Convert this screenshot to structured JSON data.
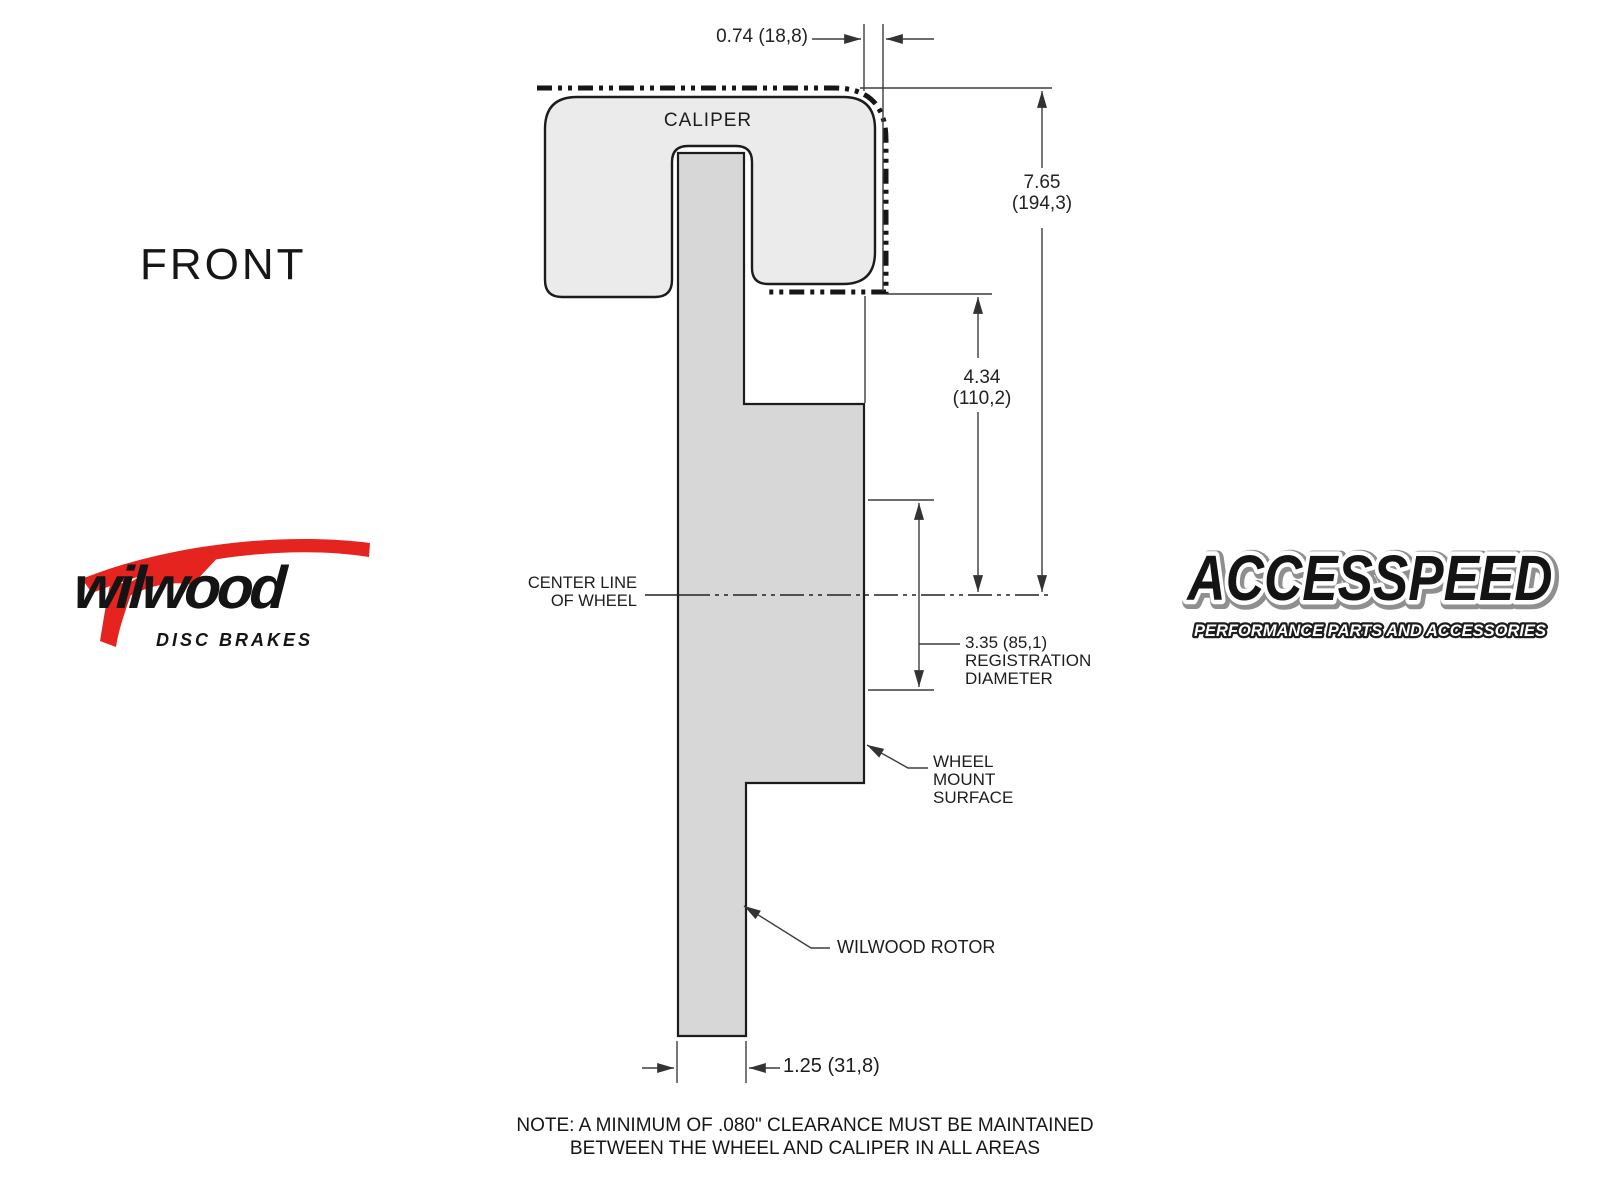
{
  "colors": {
    "background": "#ffffff",
    "caliper_fill": "#ebebeb",
    "rotor_fill": "#d7d7d7",
    "outline": "#1c1c1c",
    "dimension_line": "#3d3d3d",
    "wilwood_red": "#e5231f",
    "logo_black": "#141414"
  },
  "front_label": "FRONT",
  "caliper_label": "CALIPER",
  "dimensions": {
    "overhang": "0.74 (18,8)",
    "height_in": "7.65",
    "height_mm": "(194,3)",
    "mount_to_center_in": "4.34",
    "mount_to_center_mm": "(110,2)",
    "registration": "3.35 (85,1)",
    "registration_label1": "REGISTRATION",
    "registration_label2": "DIAMETER",
    "rotor_width": "1.25 (31,8)"
  },
  "labels": {
    "centerline1": "CENTER LINE",
    "centerline2": "OF WHEEL",
    "wheel_mount1": "WHEEL",
    "wheel_mount2": "MOUNT",
    "wheel_mount3": "SURFACE",
    "rotor": "WILWOOD ROTOR"
  },
  "note": {
    "line1": "NOTE: A MINIMUM OF .080\" CLEARANCE MUST BE MAINTAINED",
    "line2": "BETWEEN THE WHEEL AND CALIPER IN ALL AREAS"
  },
  "logos": {
    "wilwood": {
      "name": "wilwood",
      "tagline": "DISC BRAKES"
    },
    "accesspeed": {
      "name": "ACCESSPEED",
      "tagline": "PERFORMANCE PARTS AND ACCESSORIES"
    }
  }
}
